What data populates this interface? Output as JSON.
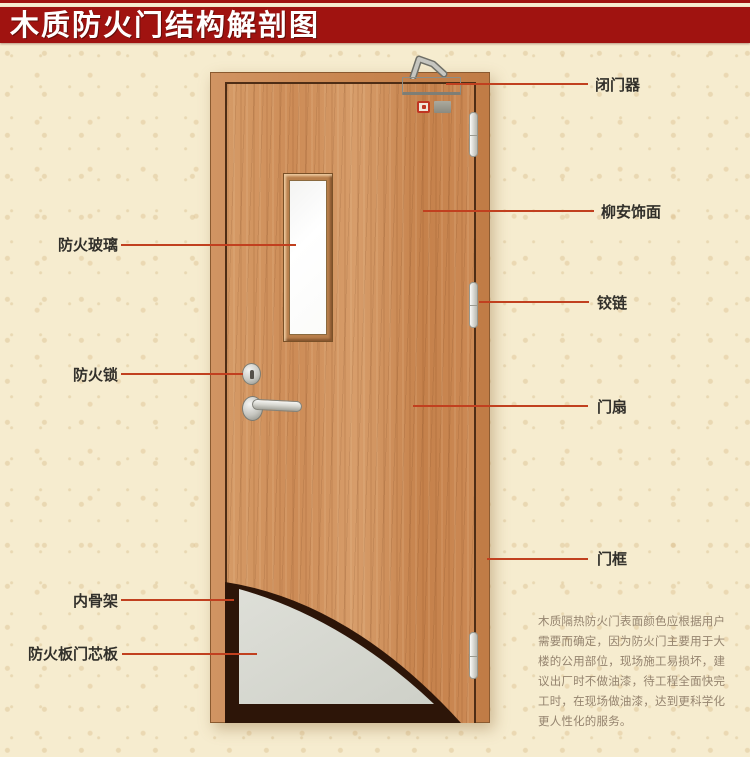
{
  "title": "木质防火门结构解剖图",
  "callouts": {
    "left": [
      {
        "id": "fire-glass",
        "text": "防火玻璃"
      },
      {
        "id": "fire-lock",
        "text": "防火锁"
      },
      {
        "id": "inner-skeleton",
        "text": "内骨架"
      },
      {
        "id": "fire-core",
        "text": "防火板门芯板"
      }
    ],
    "right": [
      {
        "id": "door-closer",
        "text": "闭门器"
      },
      {
        "id": "lauan-veneer",
        "text": "柳安饰面"
      },
      {
        "id": "hinge",
        "text": "铰链"
      },
      {
        "id": "door-leaf",
        "text": "门扇"
      },
      {
        "id": "door-frame",
        "text": "门框"
      }
    ]
  },
  "description": {
    "text": "木质隔热防火门表面颜色应根据用户\n需要而确定，因为防火门主要用于大\n楼的公用部位，现场施工易损坏，建\n议出厂时不做油漆，待工程全面快完\n工时，在现场做油漆，达到更科学化\n更人性化的服务。"
  },
  "colors": {
    "title_bg": "#a01310",
    "title_text": "#ffffff",
    "callout_line": "#c1401f",
    "label_text": "#32302b",
    "description_text": "#95846f",
    "background": "#f6eccf",
    "door_wood": "#cd8c57",
    "inner_skeleton": "#2d1508",
    "core_panel": "#d9dad3"
  }
}
